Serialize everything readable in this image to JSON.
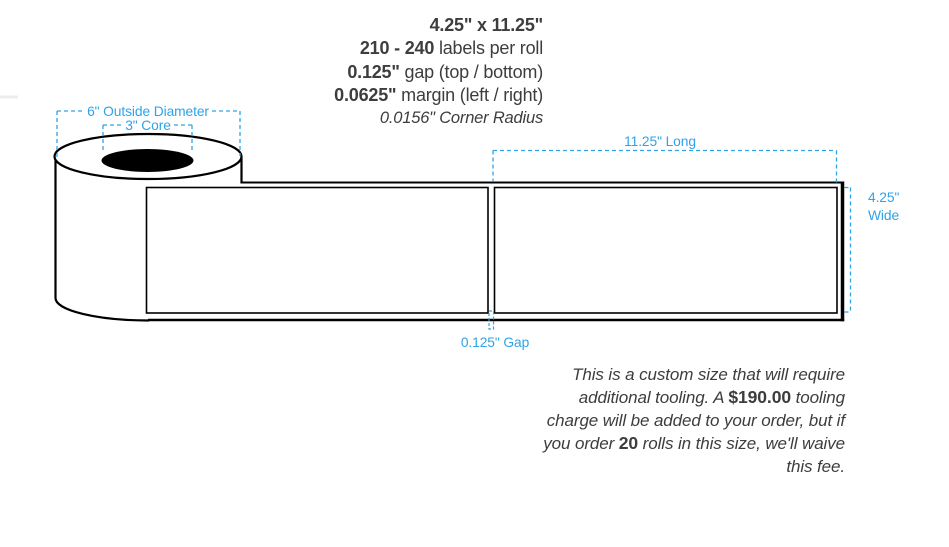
{
  "colors": {
    "accent_blue": "#2fa3e8",
    "ink": "#000000",
    "text_gray": "#3d3d3d"
  },
  "specs": {
    "size_bold": "4.25\" x 11.25\"",
    "count_bold": "210 - 240",
    "count_rest": " labels per roll",
    "gap_bold": "0.125\"",
    "gap_rest": " gap (top / bottom)",
    "margin_bold": "0.0625\"",
    "margin_rest": " margin (left / right)",
    "corner_radius_italic": "0.0156\" Corner Radius"
  },
  "diagram": {
    "outside_diameter_label": "6\" Outside Diameter",
    "core_label": "3\" Core",
    "length_label": "11.25\" Long",
    "width_label_line1": "4.25\"",
    "width_label_line2": "Wide",
    "gap_label": "0.125\" Gap"
  },
  "note": {
    "lines": [
      {
        "segments": [
          {
            "text": "This is a custom size that will require"
          }
        ]
      },
      {
        "segments": [
          {
            "text": "additional tooling. A "
          },
          {
            "text": "$190.00",
            "bold": true
          },
          {
            "text": " tooling"
          }
        ]
      },
      {
        "segments": [
          {
            "text": "charge will be added to your order, but if"
          }
        ]
      },
      {
        "segments": [
          {
            "text": "you order "
          },
          {
            "text": "20",
            "bold": true
          },
          {
            "text": " rolls in this size, we'll waive"
          }
        ]
      },
      {
        "segments": [
          {
            "text": "this fee."
          }
        ]
      }
    ]
  }
}
